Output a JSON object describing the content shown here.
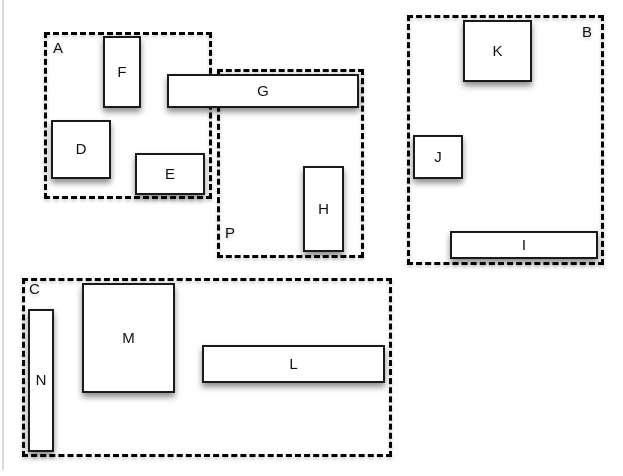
{
  "diagram": {
    "groups": {
      "a": {
        "label": "A"
      },
      "b": {
        "label": "B"
      },
      "c": {
        "label": "C"
      },
      "p": {
        "label": "P"
      }
    },
    "boxes": {
      "d": {
        "label": "D"
      },
      "e": {
        "label": "E"
      },
      "f": {
        "label": "F"
      },
      "g": {
        "label": "G"
      },
      "h": {
        "label": "H"
      },
      "i": {
        "label": "I"
      },
      "j": {
        "label": "J"
      },
      "k": {
        "label": "K"
      },
      "l": {
        "label": "L"
      },
      "m": {
        "label": "M"
      },
      "n": {
        "label": "N"
      }
    },
    "colors": {
      "background": "#ffffff",
      "box_fill": "#ffffff",
      "box_border": "#1a1a1a",
      "group_border": "#000000",
      "label_text": "#111111"
    }
  }
}
